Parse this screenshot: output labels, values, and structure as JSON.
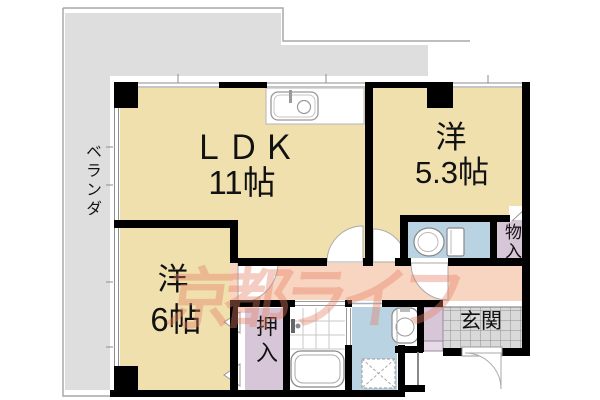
{
  "floor_plan": {
    "watermark": "京都ライフ",
    "rooms": {
      "ldk": {
        "label": "ＬＤＫ",
        "size": "11帖"
      },
      "western_53": {
        "label": "洋",
        "size": "5.3帖"
      },
      "western_6": {
        "label": "洋",
        "size": "6帖"
      },
      "veranda": {
        "label": "ベランダ"
      },
      "closet": {
        "label": "押入"
      },
      "storage": {
        "label": "物入"
      },
      "entrance": {
        "label": "玄関"
      }
    },
    "colors": {
      "room_floor": "#EFE0AE",
      "veranda": "#DEDEDE",
      "hallway": "#F8D5C1",
      "closet": "#D7C5D8",
      "closet_light": "#E7DAE7",
      "wet_area": "#B9D3E3",
      "tile": "#D9D9D9",
      "wall": "#000000",
      "watermark_color": "rgba(229,128,100,0.40)",
      "outline": "#A8A8A8"
    }
  }
}
